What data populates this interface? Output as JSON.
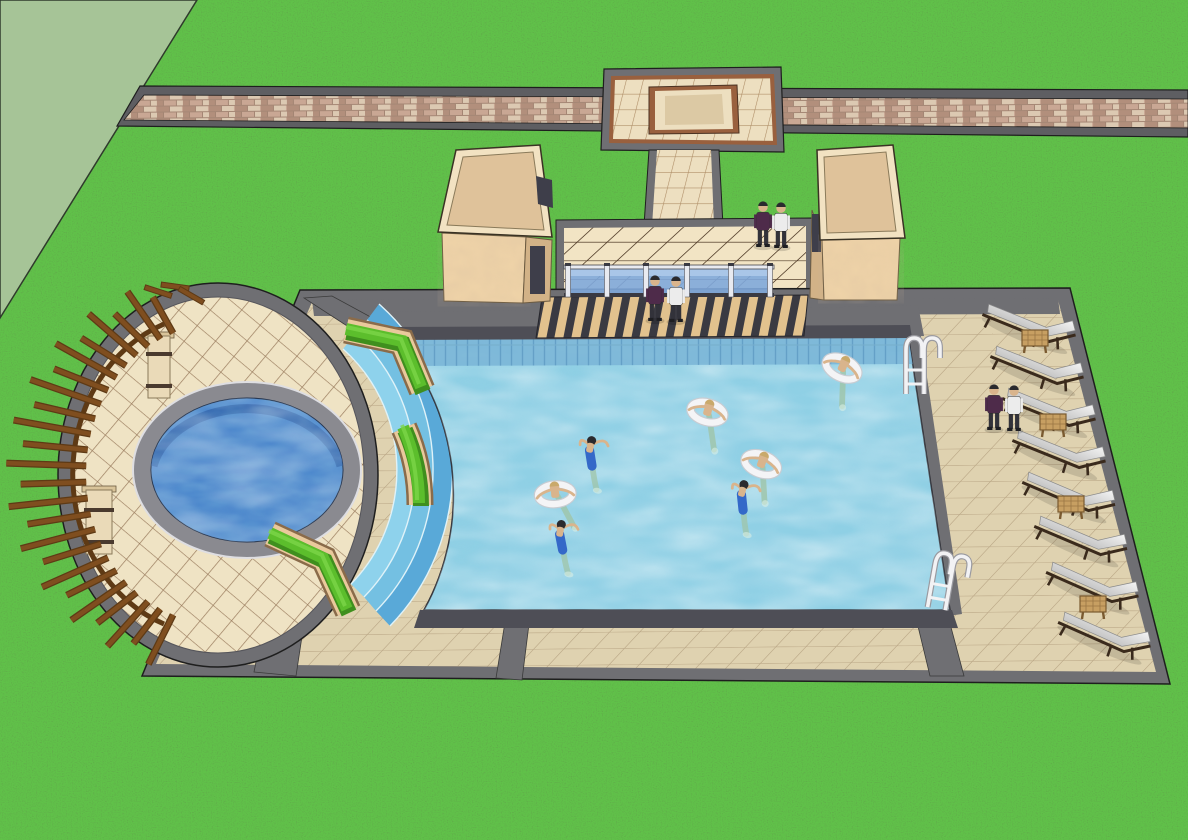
{
  "scene": {
    "description": "3D architectural model render of a resort swimming pool complex viewed from above: brick walkway and tiled plaza at top, two tan pavilions flanking a glass-railed entrance deck, large rectangular pool with seven swimmers (four on white swim rings), circular spa deck with curved wooden pergola on the left, chevron hedges and curved blue entry steps, and a right-side deck with eight white lounge chairs, wooden side tables, two pool ladders and three pairs of standing people"
  },
  "colors": {
    "flat_ground": "#A6C497",
    "grass": "#63A04A",
    "walk_gray": "#5E5E62",
    "band_gray": "#6F6F73",
    "band_dark": "#3A3A3E",
    "plaza_tile": "#EDDFC0",
    "plaza_line": "#AE8D66",
    "plaza_trim": "#99603E",
    "deck_tile": "#DFD2B0",
    "deck_line": "#BCA988",
    "entrance_tile": "#F2E4C4",
    "entrance_line": "#55402C",
    "circle_tile": "#EFE3C4",
    "circle_line": "#9A7C5E",
    "pool_water": "#8FD0E5",
    "pool_tileband": "#79B4D6",
    "pool_tile_line": "#5E9AC2",
    "coping": "#4E4E56",
    "spa_water": "#4B86CC",
    "spa_tile": "#2E5FA8",
    "spa_coping": "#8A8A90",
    "step_blue_1": "#8ED2EC",
    "step_blue_2": "#74C0E2",
    "step_blue_3": "#59A9D8",
    "step_rim": "#DFF2F8",
    "hedge_green": "#5CBE2C",
    "hedge_dark": "#3F8F1E",
    "hedge_light": "#7CD648",
    "planter": "#E9C99C",
    "planter_dark": "#8A6B4A",
    "wood": "#7F4E1F",
    "wood_dark": "#5E3A15",
    "pillar": "#EADAB8",
    "pillar_band": "#4A3A2E",
    "pavilion_roof": "#DFC29A",
    "pavilion_trim": "#F2E2C2",
    "pavilion_wall": "#EFD3A8",
    "pavilion_side": "#D2B287",
    "opening": "#3E3E4A",
    "glass": "#7FA9DC",
    "glass_light": "#A9C6E8",
    "rail_white": "#E8EAF0",
    "rail_dark": "#3A3A42",
    "stair_dark": "#3A3A42",
    "stair_tan": "#E2C28E",
    "cushion": "#F4F4F4",
    "cushion_shade": "#C6C6C6",
    "chair_frame": "#3A2A1C",
    "table_wood": "#C79F62",
    "table_dark": "#7A5A30",
    "ladder": "#F2F2F4",
    "skin": "#D9B48C",
    "hair_dark": "#2A2A2E",
    "ring_white": "#F4F4F6",
    "ring_shade": "#C8CCD2",
    "trunks": "#3468C8",
    "legs_water": "#9FC4A8",
    "splash": "#D8EFE4",
    "person_dark_top": "#4E2B4A",
    "person_white_top": "#ECECEC",
    "person_pants": "#32323A",
    "brick_base": "#C9A794",
    "brick_dark": "#B28F7C",
    "brick_light": "#DCC9B2"
  },
  "pergola": {
    "cx": 212,
    "cy": 474,
    "slat_count": 24,
    "angle_start": 108,
    "angle_end": 252,
    "inner_rx": 126,
    "inner_ry": 148,
    "outer_rx": 206,
    "outer_ry": 200,
    "loose_slats": [
      {
        "x": 158,
        "y": 292,
        "rot": 18
      },
      {
        "x": 175,
        "y": 287,
        "rot": 8
      },
      {
        "x": 191,
        "y": 296,
        "rot": 30
      }
    ]
  },
  "railing": {
    "posts": [
      568,
      607,
      646,
      687,
      731,
      770
    ],
    "x1": 566,
    "x2": 772,
    "glass_top": 269,
    "glass_bottom": 294
  },
  "ladders": [
    {
      "x": 906,
      "y": 334,
      "rot": 0
    },
    {
      "x": 938,
      "y": 548,
      "rot": 10
    }
  ],
  "lounge_chairs": [
    {
      "x": 988,
      "y": 306,
      "rot": 22
    },
    {
      "x": 996,
      "y": 348,
      "rot": 22
    },
    {
      "x": 1008,
      "y": 390,
      "rot": 22
    },
    {
      "x": 1018,
      "y": 432,
      "rot": 22
    },
    {
      "x": 1028,
      "y": 474,
      "rot": 23
    },
    {
      "x": 1040,
      "y": 518,
      "rot": 23
    },
    {
      "x": 1052,
      "y": 564,
      "rot": 24
    },
    {
      "x": 1064,
      "y": 614,
      "rot": 24
    }
  ],
  "side_tables": [
    {
      "x": 1022,
      "y": 330
    },
    {
      "x": 1040,
      "y": 414
    },
    {
      "x": 1058,
      "y": 496
    },
    {
      "x": 1080,
      "y": 596
    }
  ],
  "swimmers": [
    {
      "x": 843,
      "y": 366,
      "rot": 25,
      "type": "ring",
      "hair": "#C9A96B"
    },
    {
      "x": 708,
      "y": 410,
      "rot": 15,
      "type": "ring",
      "hair": "#C9A96B"
    },
    {
      "x": 762,
      "y": 462,
      "rot": 20,
      "type": "ring",
      "hair": "#C9A96B"
    },
    {
      "x": 555,
      "y": 492,
      "rot": -5,
      "type": "ring",
      "hair": "#C9A96B"
    },
    {
      "x": 590,
      "y": 448,
      "rot": 12,
      "type": "swim",
      "hair": "#2A2A2E"
    },
    {
      "x": 742,
      "y": 492,
      "rot": 15,
      "type": "swim",
      "hair": "#2A2A2E"
    },
    {
      "x": 560,
      "y": 532,
      "rot": 10,
      "type": "swim",
      "hair": "#2A2A2E"
    }
  ],
  "people": [
    {
      "x": 763,
      "y": 247,
      "top": "person_dark_top",
      "location": "entrance-deck"
    },
    {
      "x": 781,
      "y": 248,
      "top": "person_white_top",
      "location": "entrance-deck"
    },
    {
      "x": 655,
      "y": 321,
      "top": "person_dark_top",
      "location": "entry-steps"
    },
    {
      "x": 676,
      "y": 322,
      "top": "person_white_top",
      "location": "entry-steps"
    },
    {
      "x": 994,
      "y": 430,
      "top": "person_dark_top",
      "location": "lounge-deck"
    },
    {
      "x": 1014,
      "y": 431,
      "top": "person_white_top",
      "location": "lounge-deck"
    }
  ]
}
